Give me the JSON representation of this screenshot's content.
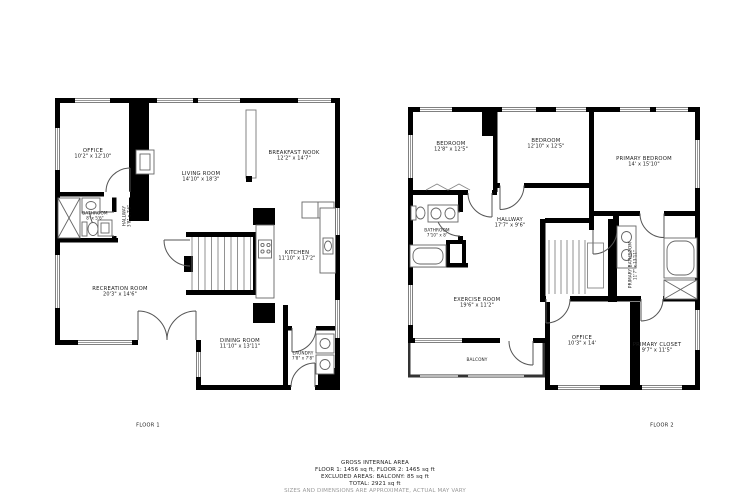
{
  "colors": {
    "wall": "#000000",
    "line": "#555555",
    "text": "#1b1b1b",
    "muted": "#9a9a9a"
  },
  "floor1": {
    "label": "FLOOR 1",
    "rooms": {
      "office": {
        "name": "OFFICE",
        "dims": "10'2\" x 12'10\""
      },
      "living_room": {
        "name": "LIVING ROOM",
        "dims": "14'10\" x 18'3\""
      },
      "breakfast_nook": {
        "name": "BREAKFAST NOOK",
        "dims": "12'2\" x 14'7\""
      },
      "bathroom": {
        "name": "BATHROOM",
        "dims": "8' x 5'6\""
      },
      "hallway": {
        "name": "HALLWAY",
        "dims": "3'8\" x 7'6\""
      },
      "recreation_room": {
        "name": "RECREATION ROOM",
        "dims": "20'3\" x 14'6\""
      },
      "kitchen": {
        "name": "KITCHEN",
        "dims": "11'10\" x 17'2\""
      },
      "dining_room": {
        "name": "DINING ROOM",
        "dims": "11'10\" x 13'11\""
      },
      "laundry": {
        "name": "LAUNDRY",
        "dims": "7'8\" x 7'8\""
      }
    }
  },
  "floor2": {
    "label": "FLOOR 2",
    "rooms": {
      "bedroom_1": {
        "name": "BEDROOM",
        "dims": "12'8\" x 12'5\""
      },
      "bedroom_2": {
        "name": "BEDROOM",
        "dims": "12'10\" x 12'5\""
      },
      "primary_bedroom": {
        "name": "PRIMARY BEDROOM",
        "dims": "14' x 15'10\""
      },
      "hallway": {
        "name": "HALLWAY",
        "dims": "17'7\" x 9'6\""
      },
      "bathroom": {
        "name": "BATHROOM",
        "dims": "7'10\" x 8'"
      },
      "exercise_room": {
        "name": "EXERCISE ROOM",
        "dims": "19'6\" x 11'2\""
      },
      "primary_bathroom": {
        "name": "PRIMARY BATHROOM",
        "dims": "11'7\" x 13'11\""
      },
      "office": {
        "name": "OFFICE",
        "dims": "10'3\" x 14'"
      },
      "primary_closet": {
        "name": "PRIMARY CLOSET",
        "dims": "9'7\" x 11'5\""
      },
      "balcony": {
        "name": "BALCONY",
        "dims": ""
      }
    }
  },
  "footer": {
    "gross_title": "GROSS INTERNAL AREA",
    "floors_line": "FLOOR 1: 1456 sq ft, FLOOR 2: 1465 sq ft",
    "excluded_line": "EXCLUDED AREAS: BALCONY: 85 sq ft",
    "total_line": "TOTAL: 2921 sq ft",
    "disclaimer": "SIZES AND DIMENSIONS ARE APPROXIMATE, ACTUAL MAY VARY"
  }
}
